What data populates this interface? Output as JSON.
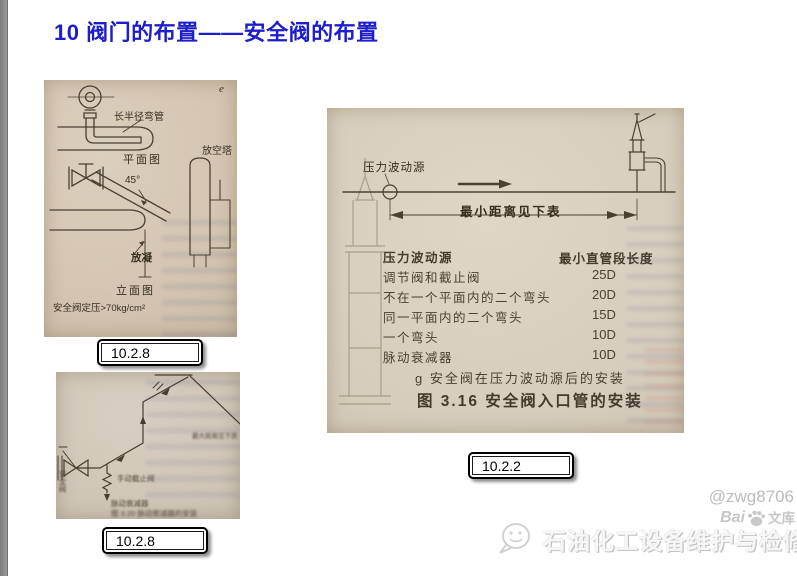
{
  "slide": {
    "title": "10 阀门的布置——安全阀的布置"
  },
  "fig_plan_elevation": {
    "corner_mark": "e",
    "long_radius_elbow": "长半径弯管",
    "plan_view": "平面图",
    "vent_tower": "放空塔",
    "angle_45": "45°",
    "drain": "放凝",
    "elevation_view": "立面图",
    "set_pressure": "安全阀定压>70kg/cm²",
    "tag": "10.2.8"
  },
  "fig_pulsation_line": {
    "safety_valve": "安全阀",
    "manual_stop_valve": "手动截止阀",
    "pulse_damper": "脉动衰减器",
    "max_distance_note": "最大距离见下表",
    "caption": "图 3.20 脉动衰减器的安装",
    "tag": "10.2.8"
  },
  "fig_inlet_piping": {
    "pressure_source": "压力波动源",
    "min_distance_note": "最小距离见下表",
    "table": {
      "header_item": "压力波动源",
      "header_value": "最小直管段长度",
      "rows": [
        {
          "item": "调节阀和截止阀",
          "value": "25D"
        },
        {
          "item": "不在一个平面内的二个弯头",
          "value": "20D"
        },
        {
          "item": "同一平面内的二个弯头",
          "value": "15D"
        },
        {
          "item": "一个弯头",
          "value": "10D"
        },
        {
          "item": "脉动衰减器",
          "value": "10D"
        }
      ]
    },
    "caption_g": "g  安全阀在压力波动源后的安装",
    "caption_figure": "图 3.16  安全阀入口管的安装",
    "tag": "10.2.2"
  },
  "watermarks": {
    "user_id": "@zwg8706",
    "baidu_bai": "Bai",
    "baidu_wenku": "文库",
    "footer_site": "石油化工设备维护与检修网"
  }
}
